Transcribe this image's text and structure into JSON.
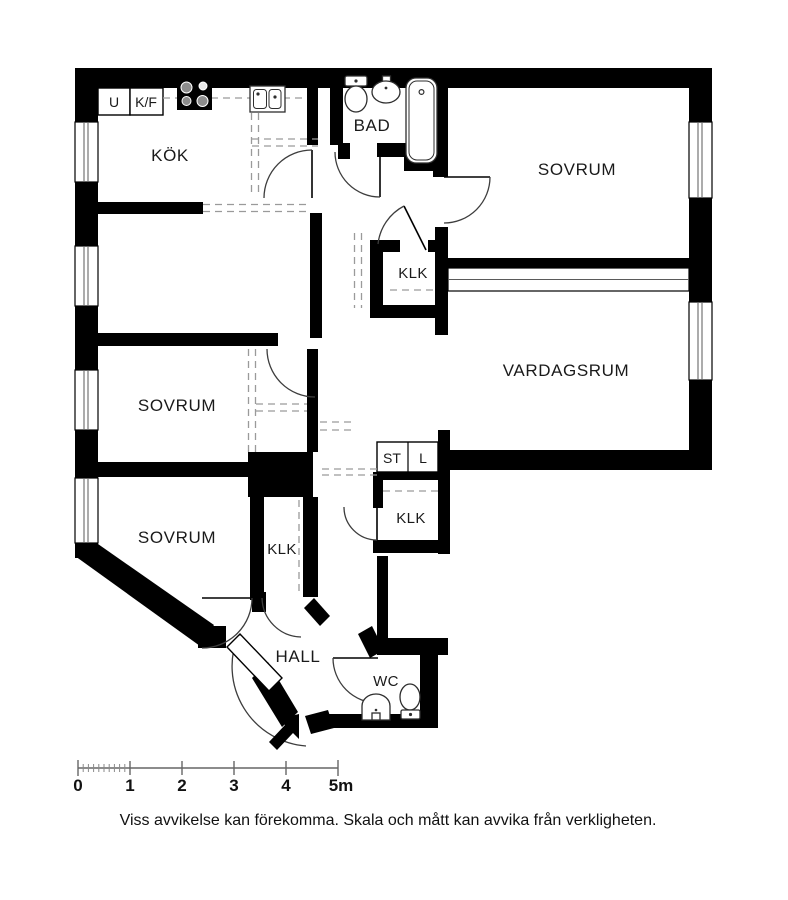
{
  "floorplan": {
    "rooms": {
      "kitchen": "KÖK",
      "bathroom": "BAD",
      "bedroom_top": "SOVRUM",
      "living_room": "VARDAGSRUM",
      "bedroom_mid": "SOVRUM",
      "bedroom_bottom": "SOVRUM",
      "closet_upper": "KLK",
      "closet_mid": "KLK",
      "closet_lower": "KLK",
      "hall": "HALL",
      "wc": "WC",
      "cleaning_closet": "ST",
      "linen_closet": "L",
      "oven_unit": "U",
      "fridge_freezer": "K/F"
    },
    "icons": {
      "stove": "stove-icon",
      "kitchen_sink": "sink-icon",
      "bath_toilet": "toilet-icon",
      "bath_basin": "washbasin-icon",
      "bathtub": "bathtub-icon",
      "wc_basin": "washbasin-icon",
      "wc_toilet": "toilet-icon",
      "entrance_arrow": "entrance-arrow-icon"
    },
    "colors": {
      "wall": "#000000",
      "background": "#ffffff",
      "fixture_stroke": "#2e2e2e",
      "dashed_line": "#9a9a9a"
    }
  },
  "scale_bar": {
    "labels": [
      "0",
      "1",
      "2",
      "3",
      "4",
      "5m"
    ]
  },
  "disclaimer": "Viss avvikelse kan förekomma. Skala och mått kan avvika från verkligheten."
}
